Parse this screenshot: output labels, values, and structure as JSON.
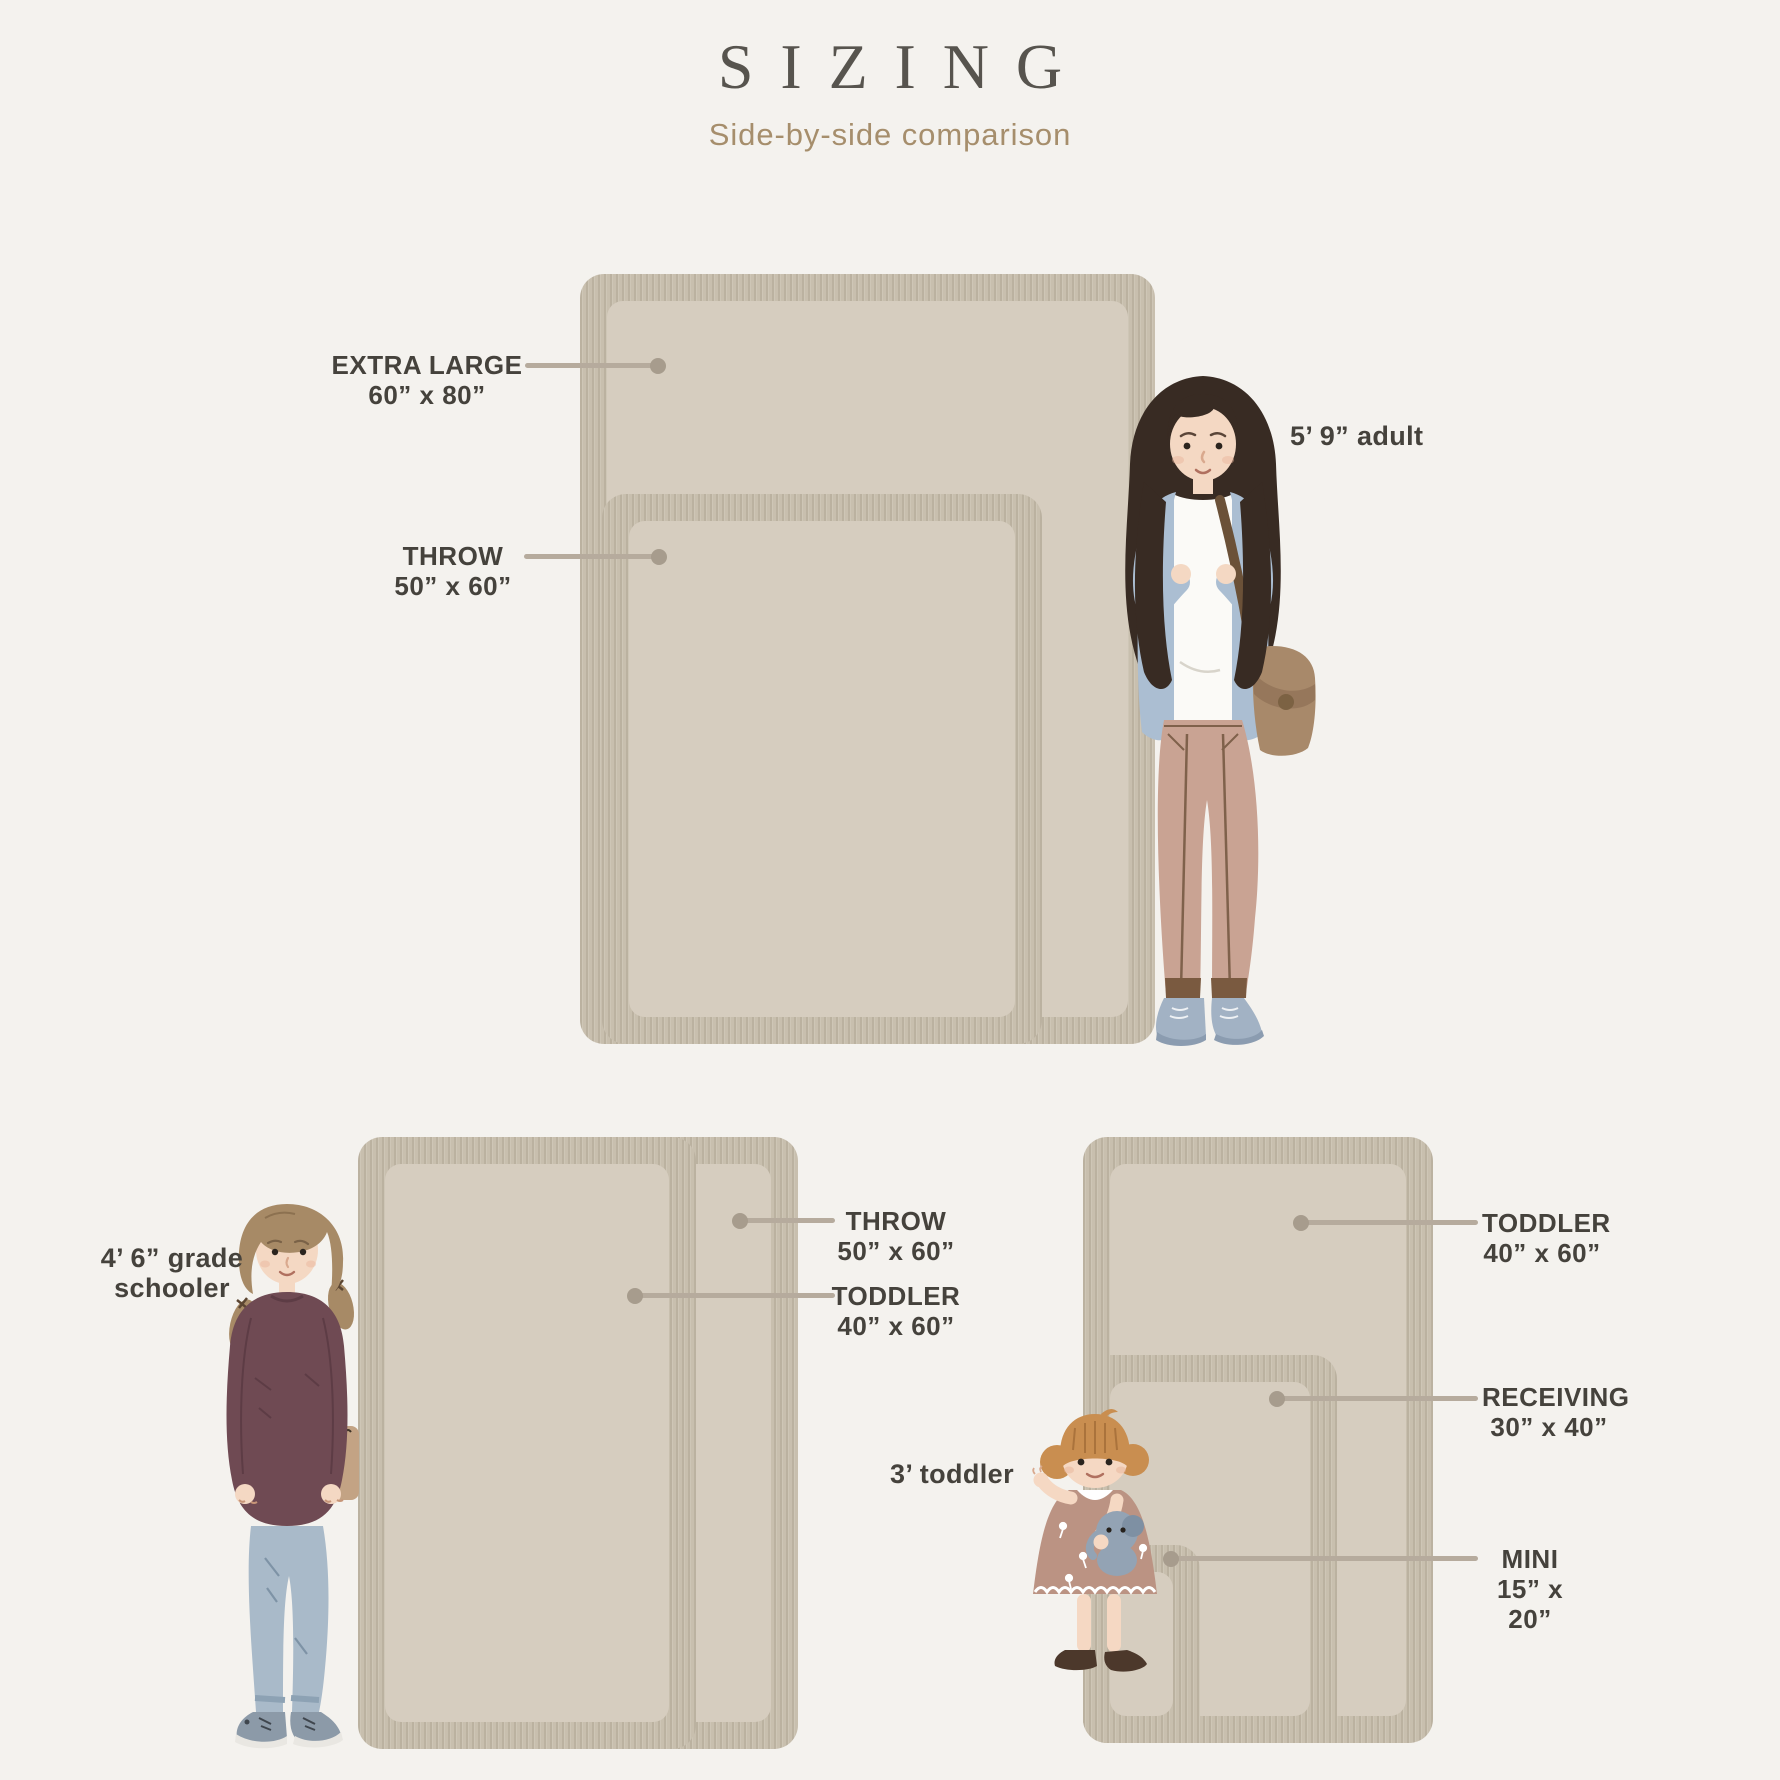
{
  "header": {
    "title": "SIZING",
    "subtitle": "Side-by-side comparison"
  },
  "blankets": {
    "extra_large": {
      "name": "EXTRA LARGE",
      "size": "60” x 80”"
    },
    "throw": {
      "name": "THROW",
      "size": "50” x 60”"
    },
    "toddler": {
      "name": "TODDLER",
      "size": "40” x 60”"
    },
    "receiving": {
      "name": "RECEIVING",
      "size": "30” x 40”"
    },
    "mini": {
      "name": "MINI",
      "size": "15” x 20”"
    }
  },
  "people": {
    "adult": {
      "label": "5’ 9” adult"
    },
    "grade_schooler": {
      "label": "4’ 6” grade schooler"
    },
    "toddler": {
      "label": "3’ toddler"
    }
  },
  "colors": {
    "background": "#f4f2ee",
    "blanket_fringe": "#c8bfae",
    "blanket_interior": "#d6cdbf",
    "leader_line": "#b6ab9d",
    "label_text": "#45423c",
    "title_text": "#57544e",
    "subtitle_text": "#a68e6c"
  }
}
